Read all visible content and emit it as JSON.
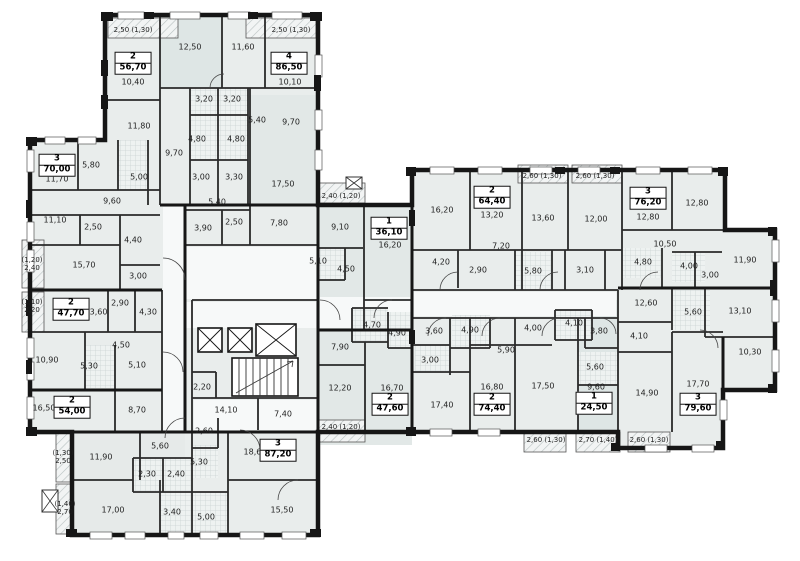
{
  "plan": {
    "rooms": [
      {
        "t": "12,50",
        "x": 190,
        "y": 47
      },
      {
        "t": "11,60",
        "x": 243,
        "y": 47
      },
      {
        "t": "10,40",
        "x": 133,
        "y": 82
      },
      {
        "t": "10,10",
        "x": 290,
        "y": 82
      },
      {
        "t": "11,80",
        "x": 139,
        "y": 126
      },
      {
        "t": "9,70",
        "x": 291,
        "y": 122
      },
      {
        "t": "5,40",
        "x": 257,
        "y": 120
      },
      {
        "t": "3,20",
        "x": 204,
        "y": 99
      },
      {
        "t": "3,20",
        "x": 232,
        "y": 99
      },
      {
        "t": "4,80",
        "x": 197,
        "y": 139
      },
      {
        "t": "4,80",
        "x": 236,
        "y": 139
      },
      {
        "t": "9,70",
        "x": 174,
        "y": 153
      },
      {
        "t": "3,00",
        "x": 201,
        "y": 177
      },
      {
        "t": "3,30",
        "x": 234,
        "y": 177
      },
      {
        "t": "17,50",
        "x": 283,
        "y": 184
      },
      {
        "t": "5,40",
        "x": 217,
        "y": 202
      },
      {
        "t": "5,80",
        "x": 91,
        "y": 165
      },
      {
        "t": "5,00",
        "x": 139,
        "y": 177
      },
      {
        "t": "11,70",
        "x": 57,
        "y": 179
      },
      {
        "t": "9,60",
        "x": 112,
        "y": 201
      },
      {
        "t": "11,10",
        "x": 55,
        "y": 220
      },
      {
        "t": "2,50",
        "x": 93,
        "y": 227
      },
      {
        "t": "3,90",
        "x": 203,
        "y": 228
      },
      {
        "t": "2,50",
        "x": 234,
        "y": 222
      },
      {
        "t": "7,80",
        "x": 279,
        "y": 223
      },
      {
        "t": "4,40",
        "x": 133,
        "y": 240
      },
      {
        "t": "15,70",
        "x": 84,
        "y": 265
      },
      {
        "t": "3,00",
        "x": 138,
        "y": 276
      },
      {
        "t": "9,10",
        "x": 340,
        "y": 227
      },
      {
        "t": "5,10",
        "x": 318,
        "y": 261
      },
      {
        "t": "4,50",
        "x": 346,
        "y": 269
      },
      {
        "t": "2,90",
        "x": 120,
        "y": 303
      },
      {
        "t": "13,60",
        "x": 96,
        "y": 312
      },
      {
        "t": "4,30",
        "x": 148,
        "y": 312
      },
      {
        "t": "4,50",
        "x": 121,
        "y": 345
      },
      {
        "t": "10,90",
        "x": 47,
        "y": 360
      },
      {
        "t": "5,30",
        "x": 89,
        "y": 366
      },
      {
        "t": "5,10",
        "x": 137,
        "y": 365
      },
      {
        "t": "16,50",
        "x": 44,
        "y": 408
      },
      {
        "t": "8,70",
        "x": 137,
        "y": 410
      },
      {
        "t": "2,20",
        "x": 202,
        "y": 387
      },
      {
        "t": "14,10",
        "x": 226,
        "y": 410
      },
      {
        "t": "7,40",
        "x": 283,
        "y": 414
      },
      {
        "t": "2,60",
        "x": 204,
        "y": 431
      },
      {
        "t": "5,30",
        "x": 199,
        "y": 462
      },
      {
        "t": "5,60",
        "x": 160,
        "y": 446
      },
      {
        "t": "11,90",
        "x": 101,
        "y": 457
      },
      {
        "t": "2,30",
        "x": 147,
        "y": 474
      },
      {
        "t": "2,40",
        "x": 176,
        "y": 474
      },
      {
        "t": "17,00",
        "x": 113,
        "y": 510
      },
      {
        "t": "3,40",
        "x": 172,
        "y": 512
      },
      {
        "t": "5,00",
        "x": 206,
        "y": 517
      },
      {
        "t": "18,60",
        "x": 255,
        "y": 452
      },
      {
        "t": "15,50",
        "x": 282,
        "y": 510
      },
      {
        "t": "12,20",
        "x": 340,
        "y": 388
      },
      {
        "t": "7,90",
        "x": 340,
        "y": 347
      },
      {
        "t": "4,70",
        "x": 372,
        "y": 325
      },
      {
        "t": "4,90",
        "x": 397,
        "y": 333
      },
      {
        "t": "16,70",
        "x": 392,
        "y": 388
      },
      {
        "t": "16,20",
        "x": 390,
        "y": 245
      },
      {
        "t": "16,20",
        "x": 442,
        "y": 210
      },
      {
        "t": "13,20",
        "x": 492,
        "y": 215
      },
      {
        "t": "7,20",
        "x": 501,
        "y": 246
      },
      {
        "t": "4,20",
        "x": 441,
        "y": 262
      },
      {
        "t": "2,90",
        "x": 478,
        "y": 270
      },
      {
        "t": "5,80",
        "x": 533,
        "y": 271
      },
      {
        "t": "13,60",
        "x": 543,
        "y": 218
      },
      {
        "t": "12,00",
        "x": 596,
        "y": 219
      },
      {
        "t": "3,10",
        "x": 585,
        "y": 270
      },
      {
        "t": "12,80",
        "x": 648,
        "y": 217
      },
      {
        "t": "12,80",
        "x": 697,
        "y": 203
      },
      {
        "t": "10,50",
        "x": 665,
        "y": 244
      },
      {
        "t": "4,80",
        "x": 643,
        "y": 262
      },
      {
        "t": "4,00",
        "x": 689,
        "y": 266
      },
      {
        "t": "3,00",
        "x": 710,
        "y": 275
      },
      {
        "t": "11,90",
        "x": 745,
        "y": 260
      },
      {
        "t": "12,60",
        "x": 646,
        "y": 303
      },
      {
        "t": "5,60",
        "x": 693,
        "y": 312
      },
      {
        "t": "13,10",
        "x": 740,
        "y": 311
      },
      {
        "t": "4,10",
        "x": 639,
        "y": 336
      },
      {
        "t": "10,30",
        "x": 750,
        "y": 352
      },
      {
        "t": "3,60",
        "x": 434,
        "y": 331
      },
      {
        "t": "3,00",
        "x": 430,
        "y": 360
      },
      {
        "t": "4,90",
        "x": 470,
        "y": 330
      },
      {
        "t": "5,90",
        "x": 506,
        "y": 350
      },
      {
        "t": "4,00",
        "x": 533,
        "y": 328
      },
      {
        "t": "4,10",
        "x": 574,
        "y": 323
      },
      {
        "t": "3,80",
        "x": 599,
        "y": 331
      },
      {
        "t": "5,60",
        "x": 595,
        "y": 367
      },
      {
        "t": "17,40",
        "x": 442,
        "y": 405
      },
      {
        "t": "16,80",
        "x": 492,
        "y": 387
      },
      {
        "t": "17,50",
        "x": 543,
        "y": 386
      },
      {
        "t": "9,60",
        "x": 596,
        "y": 387
      },
      {
        "t": "14,90",
        "x": 647,
        "y": 393
      },
      {
        "t": "17,70",
        "x": 698,
        "y": 384
      }
    ],
    "apartments": [
      {
        "num": "2",
        "area": "56,70",
        "x": 133,
        "y": 63
      },
      {
        "num": "4",
        "area": "86,50",
        "x": 289,
        "y": 63
      },
      {
        "num": "3",
        "area": "70,00",
        "x": 57,
        "y": 165
      },
      {
        "num": "2",
        "area": "47,70",
        "x": 71,
        "y": 309
      },
      {
        "num": "2",
        "area": "54,00",
        "x": 72,
        "y": 407
      },
      {
        "num": "1",
        "area": "36,10",
        "x": 389,
        "y": 228
      },
      {
        "num": "2",
        "area": "64,40",
        "x": 492,
        "y": 197
      },
      {
        "num": "3",
        "area": "76,20",
        "x": 648,
        "y": 198
      },
      {
        "num": "3",
        "area": "87,20",
        "x": 278,
        "y": 450
      },
      {
        "num": "2",
        "area": "47,60",
        "x": 390,
        "y": 404
      },
      {
        "num": "2",
        "area": "74,40",
        "x": 492,
        "y": 404
      },
      {
        "num": "1",
        "area": "24,50",
        "x": 594,
        "y": 403
      },
      {
        "num": "3",
        "area": "79,60",
        "x": 698,
        "y": 404
      }
    ],
    "balconies": [
      {
        "t": "2,50 (1,30)",
        "x": 133,
        "y": 30
      },
      {
        "t": "2,50 (1,30)",
        "x": 291,
        "y": 30
      },
      {
        "t": "(1,20)\n2,40",
        "x": 32,
        "y": 264
      },
      {
        "t": "(1,10)\n2,20",
        "x": 32,
        "y": 306
      },
      {
        "t": "(1,30)\n2,50",
        "x": 63,
        "y": 457
      },
      {
        "t": "(1,40)\n2,70",
        "x": 65,
        "y": 508
      },
      {
        "t": "2,40 (1,20)",
        "x": 341,
        "y": 196
      },
      {
        "t": "2,60 (1,30)",
        "x": 542,
        "y": 176
      },
      {
        "t": "2,60 (1,30)",
        "x": 595,
        "y": 176
      },
      {
        "t": "2,40 (1,20)",
        "x": 341,
        "y": 427
      },
      {
        "t": "2,60 (1,30)",
        "x": 546,
        "y": 440
      },
      {
        "t": "2,70 (1,40)",
        "x": 598,
        "y": 440
      },
      {
        "t": "2,60 (1,30)",
        "x": 649,
        "y": 440
      }
    ]
  },
  "colors": {
    "wall": "#161616",
    "room": "#e9edec",
    "room_dark": "#dee6e5",
    "corridor": "#f7f9f9",
    "hatch_line": "#b8c1c1",
    "wet_line": "#ccd4d4",
    "label": "#1f1f1f"
  }
}
